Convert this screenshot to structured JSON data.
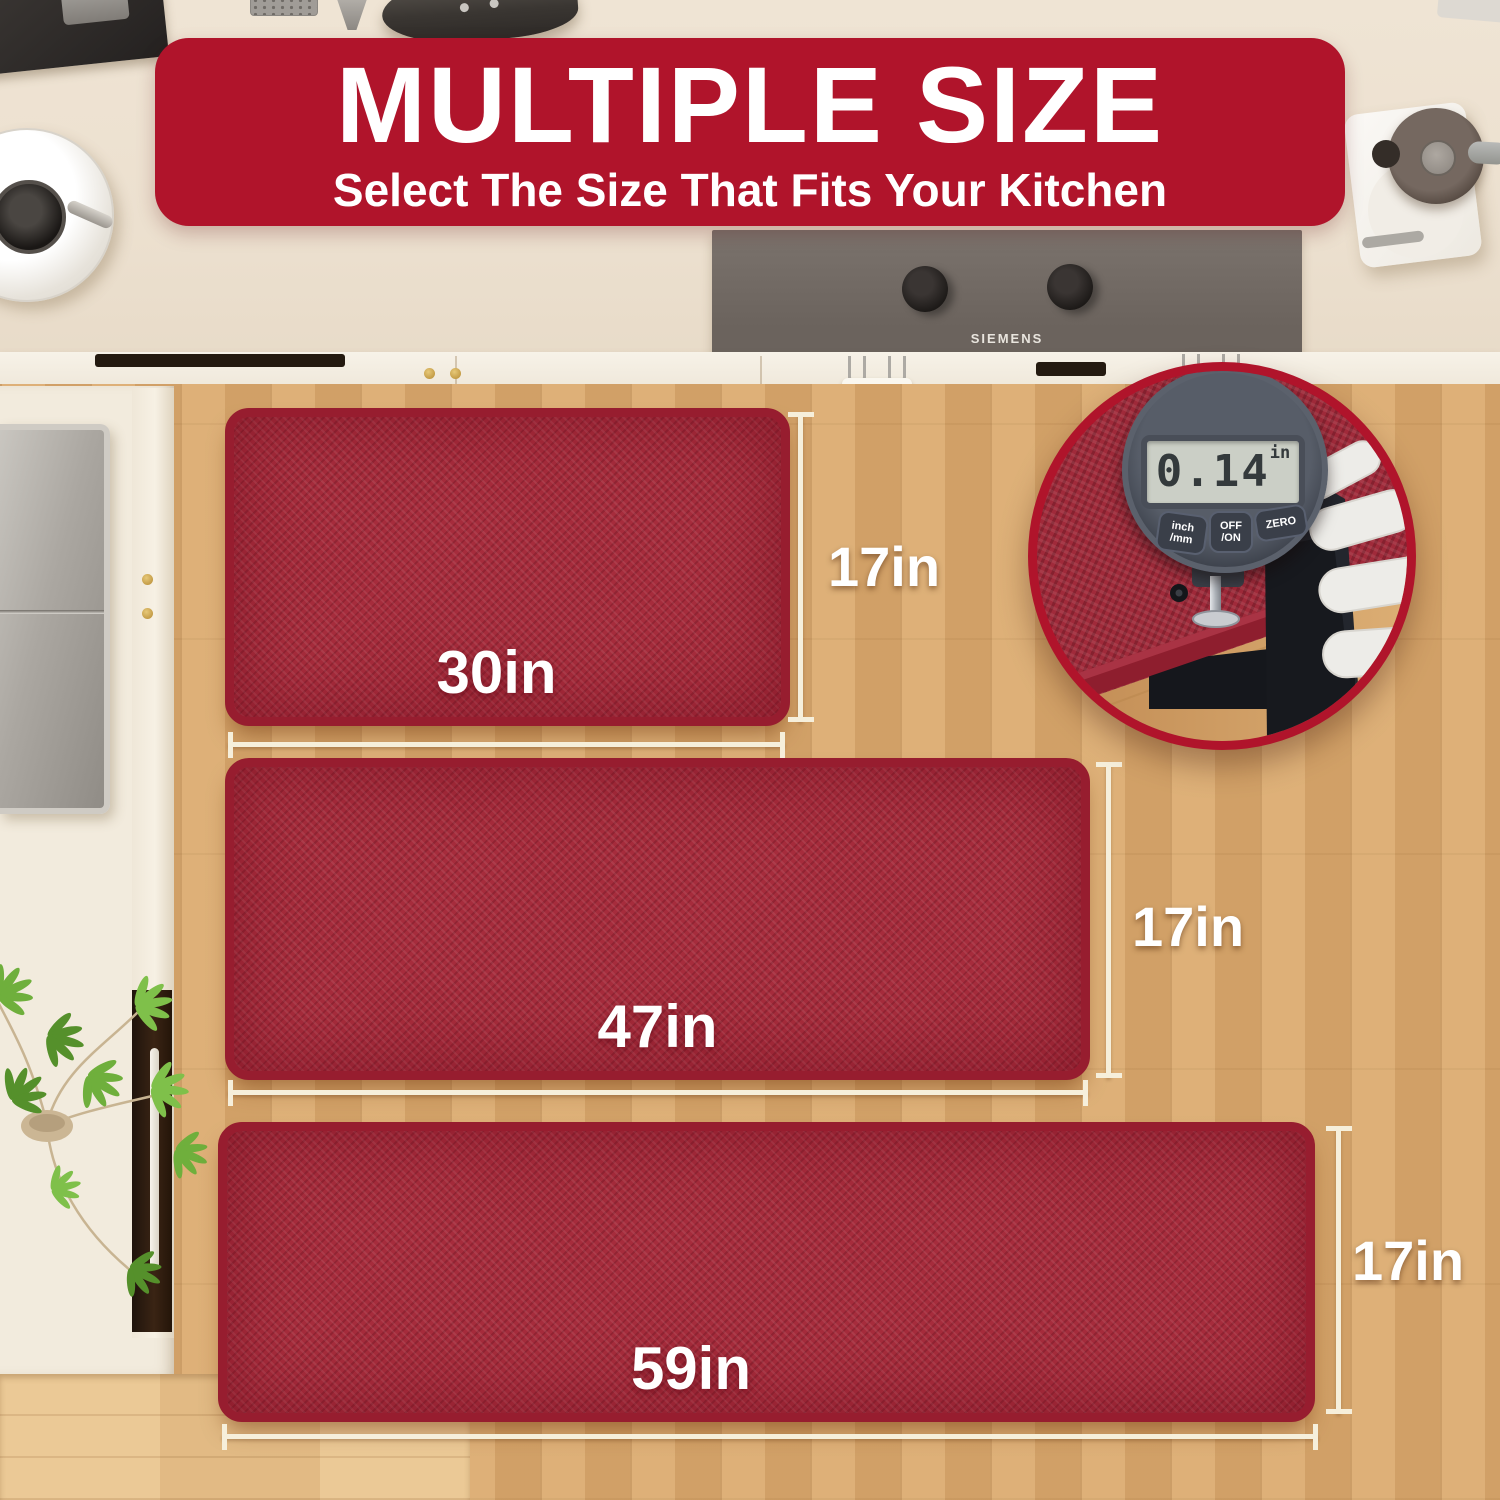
{
  "banner": {
    "title": "MULTIPLE SIZE",
    "subtitle": "Select The Size That Fits Your Kitchen"
  },
  "mats": [
    {
      "width_label": "30in",
      "height_label": "17in"
    },
    {
      "width_label": "47in",
      "height_label": "17in"
    },
    {
      "width_label": "59in",
      "height_label": "17in"
    }
  ],
  "inset": {
    "gauge_reading": "0.14",
    "gauge_unit": "in",
    "buttons": [
      {
        "line1": "inch",
        "line2": "/mm"
      },
      {
        "line1": "OFF",
        "line2": "/ON"
      },
      {
        "line1": "ZERO",
        "line2": ""
      }
    ]
  },
  "appliances": {
    "cooktop_brand": "SIEMENS"
  },
  "colors": {
    "banner_red": "#B0142B",
    "mat_red": "#A62C3C",
    "mat_border": "#971D2F",
    "floor_wood": "#D9A96F",
    "dimension_line": "#F6EFDB",
    "counter_cream": "#EDE2D1"
  }
}
